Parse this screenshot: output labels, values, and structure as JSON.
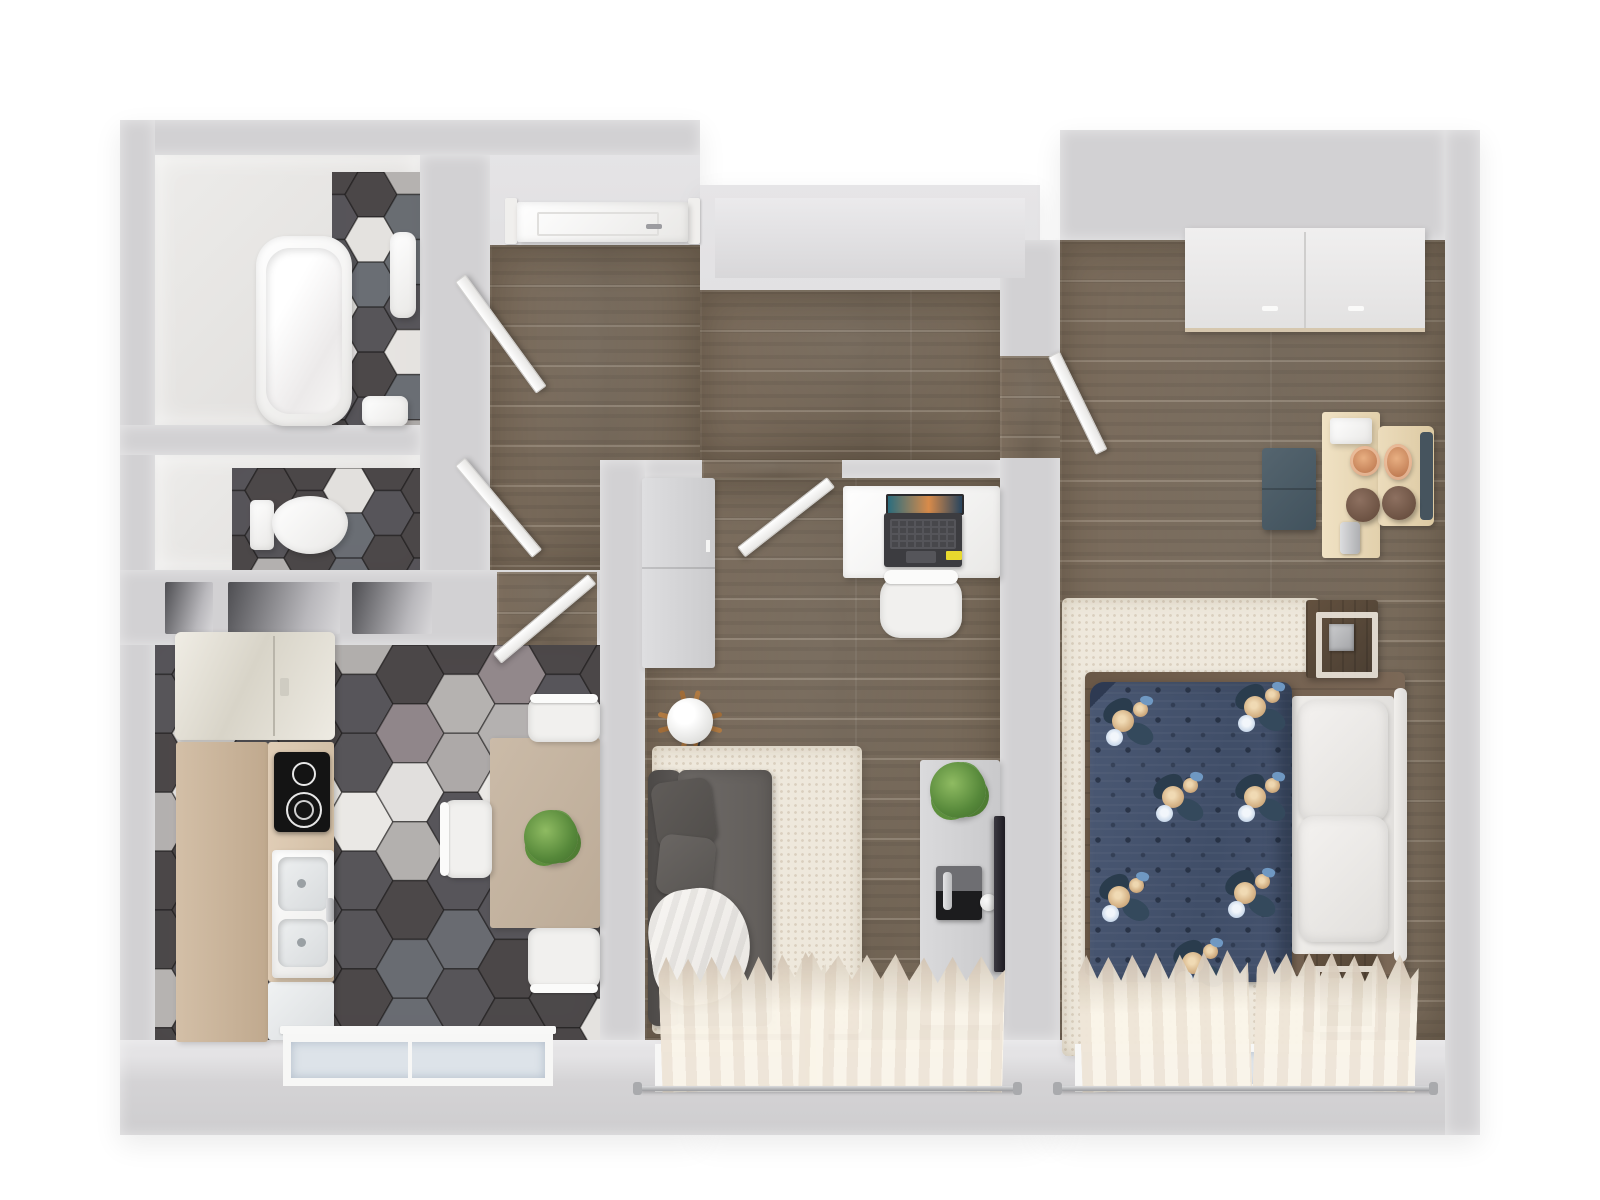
{
  "scene": {
    "type": "apartment-floor-plan-3d-top-view",
    "style": "photoreal-render",
    "background": "#ffffff",
    "visible_text": "none"
  },
  "palette": {
    "wall": "#d2d1d3",
    "wall-light": "#e6e5e7",
    "wall-deep": "#c6c5c7",
    "wood": "#77695a",
    "glass": "#dde3e9",
    "rug": "#eee8dc",
    "curtain": "#efe6d8",
    "curtain-2": "#faf5ea",
    "counter-beige": "#cdb79f",
    "counter-beige-light": "#dcc9b2",
    "table-beige": "#c6b6a3",
    "sofa-gray": "#6b6764",
    "sofa-gray-dark": "#53504e",
    "navy-duvet": "#46546f",
    "navy-deep": "#2e3a52",
    "bed-wood": "#6e5b49",
    "nightstand-wood": "#5a4b3d",
    "birch": "#ead9b9",
    "bench-slate": "#4d5d68",
    "copper": "#c07a50",
    "plant-green": "#56883a",
    "laptop-dark": "#3c3c40",
    "sticker-yellow": "#e8d92e",
    "chrome": "#c3c4c6",
    "tv-black": "#26242a"
  },
  "hex_colors": [
    "#4b4748",
    "#57555a",
    "#6a6e74",
    "#b6b3b1",
    "#eae8e5",
    "#958a8e"
  ],
  "hex_weights": [
    0.42,
    0.18,
    0.1,
    0.12,
    0.12,
    0.06
  ],
  "hex_floors": {
    "bathroom": {
      "seed": 3,
      "r": 26
    },
    "wc": {
      "seed": 8,
      "r": 26
    },
    "kitchen": {
      "seed": 11,
      "r": 34
    }
  },
  "duvet_flowers": [
    [
      16,
      20
    ],
    [
      148,
      6
    ],
    [
      66,
      96
    ],
    [
      148,
      96
    ],
    [
      12,
      196
    ],
    [
      138,
      192
    ],
    [
      86,
      262
    ]
  ],
  "rooms": [
    {
      "id": "bathroom",
      "floor": "hex-tile",
      "fixtures": [
        "bathtub",
        "pedestal-sink",
        "wash-basin"
      ]
    },
    {
      "id": "wc",
      "floor": "hex-tile",
      "fixtures": [
        "toilet"
      ]
    },
    {
      "id": "kitchen-dining",
      "floor": "hex-tile",
      "fixtures": [
        "fridge",
        "countertop",
        "cooktop",
        "double-sink",
        "dishwasher-panel",
        "dining-table",
        "dining-chair-x3",
        "potted-plant",
        "window"
      ]
    },
    {
      "id": "hallway",
      "floor": "wood-plank",
      "fixtures": [
        "entry-door",
        "wall-niches"
      ]
    },
    {
      "id": "living-room",
      "floor": "wood-plank",
      "fixtures": [
        "wardrobe",
        "desk",
        "laptop",
        "desk-chair",
        "floor-lamp",
        "rug",
        "sofa",
        "sofa-pillow-x2",
        "blanket",
        "tv-stand",
        "game-console",
        "controller",
        "tv-panel",
        "potted-plant",
        "window",
        "curtain-x2"
      ]
    },
    {
      "id": "bedroom",
      "floor": "wood-plank",
      "fixtures": [
        "built-in-closet",
        "double-bed",
        "floral-duvet",
        "pillow-x2",
        "headboard",
        "nightstand-x2",
        "cube-lamp-x2",
        "rug",
        "dressing-table",
        "dressing-chair",
        "stool-x2",
        "copper-tray-x2",
        "bench",
        "window",
        "curtain-x2"
      ]
    }
  ],
  "counts": {
    "windows": 3,
    "interior_door_leaves": 5,
    "entry_doors": 1,
    "curtain_panels": 4,
    "dining_chairs": 3,
    "wall_niches": 3
  }
}
